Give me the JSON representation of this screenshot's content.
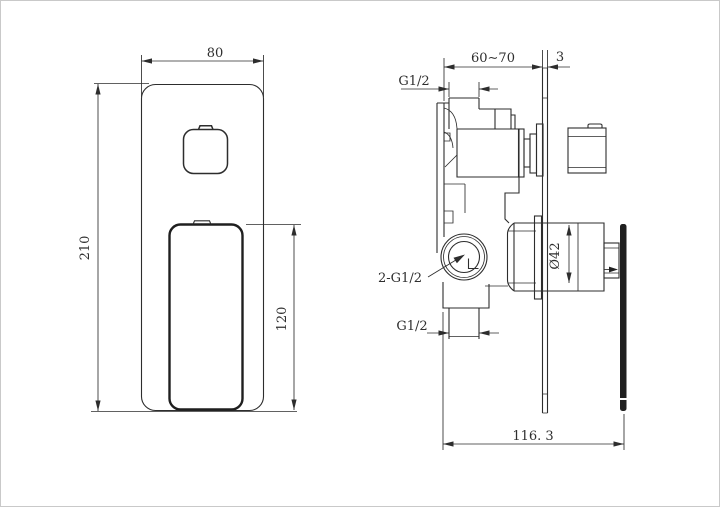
{
  "drawing": {
    "background": "#ffffff",
    "line_color": "#2d2d2d",
    "front_view": {
      "plate_width": "80",
      "plate_height": "210",
      "handle_height": "120"
    },
    "side_view": {
      "wall_depth_range": "60∼70",
      "plate_thickness": "3",
      "top_inlet_thread": "G1/2",
      "outlet_thread": "2-G1/2",
      "bottom_inlet_thread": "G1/2",
      "cartridge_diameter": "Ø42",
      "overall_depth": "116. 3"
    }
  }
}
